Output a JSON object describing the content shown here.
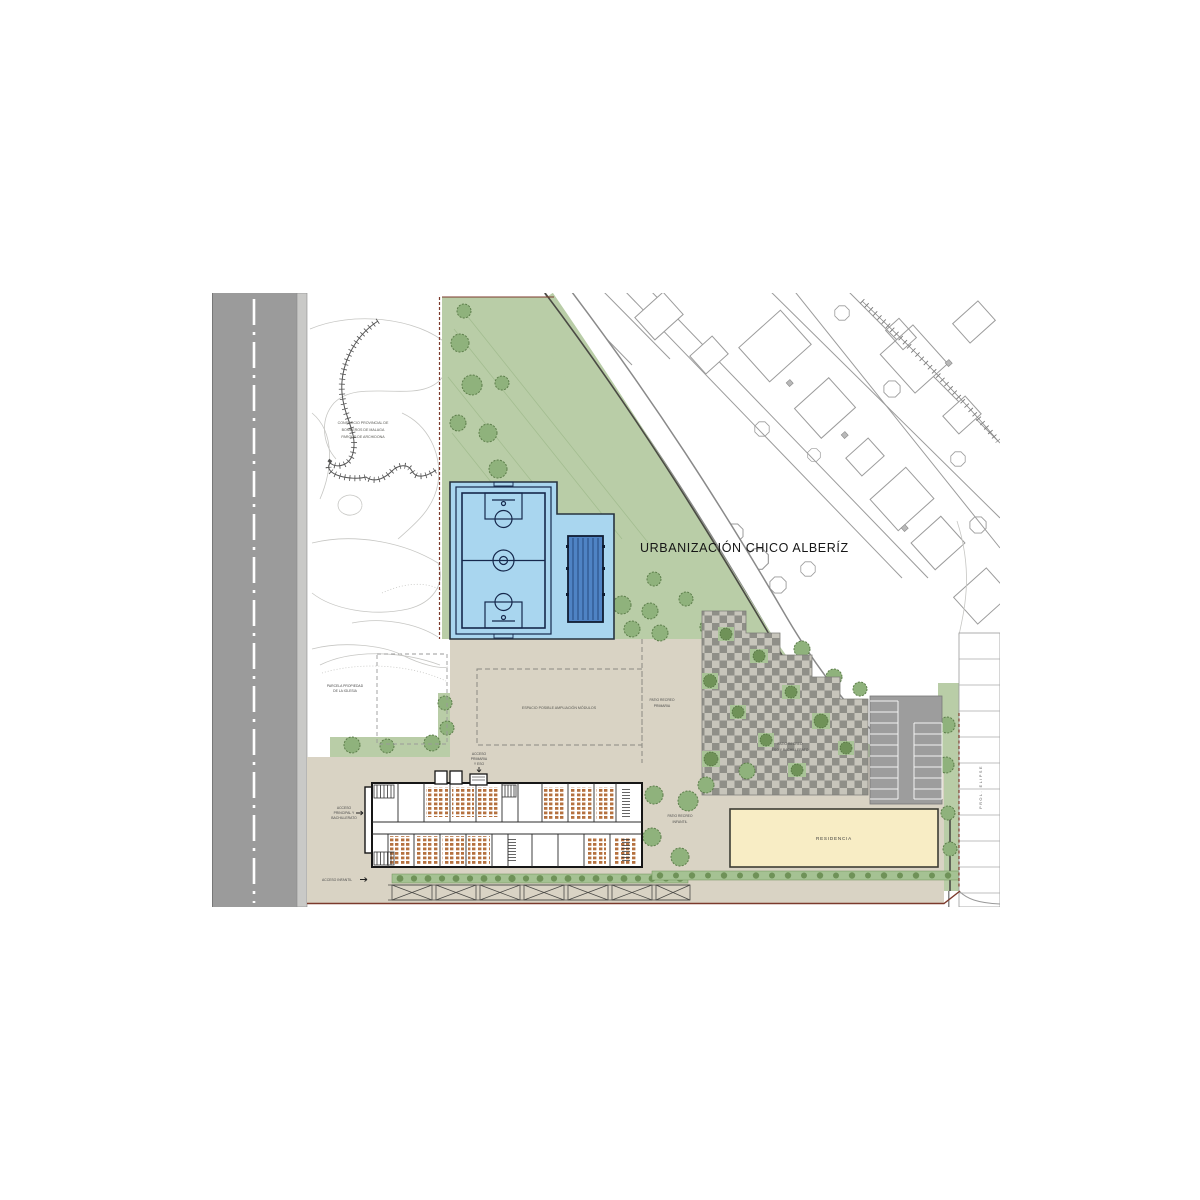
{
  "title": "URBANIZACIÓN CHICO ALBERÍZ",
  "colors": {
    "road": "#9b9b9b",
    "sidewalk": "#c9c9c7",
    "park_green": "#b9cda7",
    "tree_green": "#6f9258",
    "court_deck": "#a9d6ef",
    "court_lines": "#16284c",
    "pool_water": "#4f83c4",
    "plaza_beige": "#d9d3c4",
    "checker_dark": "#8f8f88",
    "checker_light": "#c7c5bb",
    "parking_gray": "#9d9d9d",
    "residence_cream": "#f8edc5",
    "boundary_red": "#7c3a2c",
    "building_wall": "#161616",
    "furniture_brown": "#b5713f",
    "hedge_green": "#a5c293"
  },
  "labels": {
    "consorcio": {
      "line1": "CONSORCIO PROVINCIAL DE",
      "line2": "BOMBEROS DE MALAGA",
      "line3": "PARQUE DE ARCHIDONA"
    },
    "parcela": {
      "line1": "PARCELA PROPIEDAD",
      "line2": "DE LA IGLESIA"
    },
    "ampliacion": "ESPACIO POSIBLE AMPLIACIÓN MÓDULOS",
    "patio_primaria": {
      "line1": "PATIO RECREO",
      "line2": "PRIMARIA"
    },
    "patio_eso": {
      "line1": "PATIO RECREO",
      "line2": "ESO Y BACHILLERATO"
    },
    "patio_infantil": {
      "line1": "PATIO RECREO",
      "line2": "INFANTIL"
    },
    "residencia": "RESIDENCIA",
    "acceso_primaria": {
      "line1": "ACCESO",
      "line2": "PRIMARIA",
      "line3": "Y ESO"
    },
    "acceso_principal": {
      "line1": "ACCESO",
      "line2": "PRINCIPAL Y",
      "line3": "BACHILLERATO"
    },
    "acceso_infantil": "ACCESO INFANTIL",
    "street": "PROL. ELIPSE"
  }
}
